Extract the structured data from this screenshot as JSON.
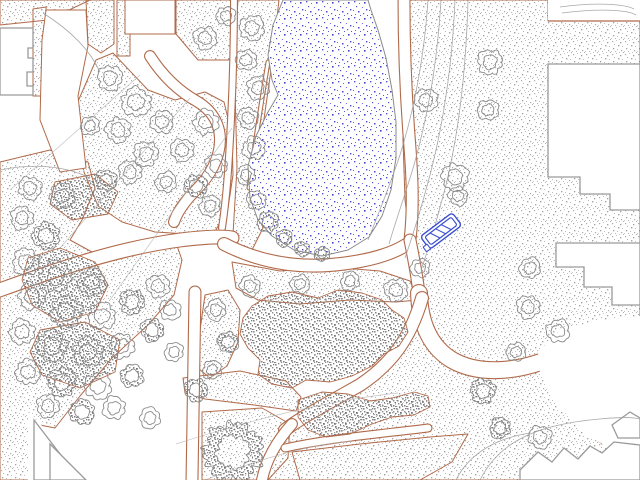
{
  "scene": {
    "colors": {
      "background": "#ffffff",
      "bed_outline": "#b06a4a",
      "building_outline": "#9a9a9a",
      "tree_line": "#8a8a8a",
      "contour": "#9f9f9f",
      "sight_line": "#b0b0b0",
      "water_dot": "#4a4ad0",
      "water_outline": "#8a8a8a",
      "bench": "#3c50d0"
    },
    "pond": {
      "pts": "283,0 273,25 268,55 272,80 278,95 268,112 256,136 248,166 250,198 258,220 272,236 294,250 322,256 348,250 369,237 382,216 391,190 396,158 396,122 392,90 386,58 378,30 371,10 368,0"
    },
    "plantings": [
      {
        "pts": "402,0 548,0 548,21 640,21 640,480 266,480 272,458 284,438 300,422 324,404 354,384 382,360 402,334 414,310 419,293 410,240 405,200 403,140 403,80"
      },
      {
        "pts": "0,0 90,0 48,20 0,25"
      },
      {
        "pts": "86,0 114,0 114,44 101,53 88,44"
      },
      {
        "pts": "33,9 46,7 46,96 33,96"
      },
      {
        "pts": "117,0 130,0 130,56 117,56"
      },
      {
        "pts": "176,0 237,0 237,60 198,60 176,34"
      },
      {
        "pts": "238,0 279,0 271,70 261,140 252,190 263,228 247,260 233,234 237,168 235,88 236,30"
      },
      {
        "pts": "76,106 96,60 113,53 148,90 175,100 205,92 224,102 232,135 233,175 228,208 216,230 188,234 155,232 122,222 98,206 84,172 74,136"
      },
      {
        "pts": "0,162 50,150 88,162 95,188 82,220 70,240 92,252 150,242 175,240 182,260 174,295 148,325 112,358 80,396 55,428 35,424 33,480 0,480"
      },
      {
        "pts": "232,262 280,271 330,267 380,271 410,281 418,300 396,302 350,300 300,304 258,300 236,288"
      },
      {
        "pts": "205,295 228,290 240,310 238,342 227,366 210,378 198,368 200,330"
      },
      {
        "pts": "183,378 240,371 286,381 301,397 296,411 254,405 205,399 185,393"
      },
      {
        "pts": "202,412 262,408 290,424 288,458 268,480 202,480"
      },
      {
        "pts": "292,452 360,444 430,437 468,434 452,462 420,480 300,480"
      },
      {
        "pts": "590,406 618,402 624,428 602,444 584,428"
      }
    ],
    "paths": [
      {
        "d": "M234,0 C234,40 233,80 231,120 C229,160 227,195 222,228",
        "w": 8
      },
      {
        "d": "M268,62 C260,110 254,150 249,188",
        "w": 5
      },
      {
        "d": "M150,56 C164,78 180,92 198,102 C214,112 220,126 220,140 C220,158 210,176 196,190 C186,200 178,210 174,222",
        "w": 12
      },
      {
        "d": "M-6,292 C60,268 120,248 180,240 C205,237 222,236 232,238",
        "w": 15
      },
      {
        "d": "M195,292 L192,480",
        "w": 13
      },
      {
        "d": "M224,244 C255,260 290,268 330,265 C365,262 390,255 406,245",
        "w": 14
      },
      {
        "d": "M404,0 C404,50 406,95 409,135 C412,172 414,205 410,240",
        "w": 13
      },
      {
        "d": "M410,240 C414,260 417,276 419,293",
        "w": 13
      },
      {
        "d": "M419,293 C420,326 432,348 452,360 C480,376 520,372 556,356 C590,342 615,336 640,334",
        "w": 18
      },
      {
        "d": "M422,298 C410,340 390,365 360,385 C330,402 300,418 285,430",
        "w": 14
      },
      {
        "d": "M292,424 C276,442 266,460 262,480",
        "w": 12
      },
      {
        "d": "M285,448 C330,438 380,434 428,428",
        "w": 9
      }
    ],
    "whites": [
      {
        "pts": "46,10 86,10 88,46 78,96 86,168 60,172 40,120 42,40",
        "stroke": true
      },
      {
        "pts": "125,0 175,0 175,34 125,34",
        "stroke": true
      },
      {
        "pts": "548,0 640,0 640,20 548,20",
        "stroke": false
      },
      {
        "pts": "538,352 560,330 600,320 640,316 640,450 612,450 580,430 554,400 540,374",
        "stroke": false
      },
      {
        "pts": "28,412 97,480 28,480",
        "stroke": false
      }
    ],
    "dense": [
      {
        "pts": "252,306 268,296 292,292 318,298 338,290 362,293 382,300 392,310 404,318 408,332 399,346 384,354 372,366 352,376 330,382 306,380 292,388 272,384 258,374 260,360 248,348 240,334 243,318"
      },
      {
        "pts": "298,400 322,392 348,394 370,401 392,398 414,392 428,396 430,407 414,415 392,417 372,424 350,434 326,437 308,430 298,417"
      },
      {
        "pts": "28,258 60,248 95,262 108,285 95,312 60,322 32,305 22,280"
      },
      {
        "pts": "40,330 85,322 120,340 115,372 80,388 42,375 30,352"
      },
      {
        "pts": "55,182 95,174 118,192 108,214 72,220 50,204"
      }
    ],
    "buildings": [
      {
        "pts": "0,28 33,28 33,48 28,48 28,58 33,58 33,72 27,72 27,86 33,86 33,95 0,95"
      },
      {
        "pts": "548,64 640,64 640,210 610,210 610,194 580,194 580,177 548,177"
      },
      {
        "pts": "556,243 640,243 640,305 612,305 612,287 584,287 584,267 556,267"
      },
      {
        "pts": "520,470 538,452 552,462 564,448 578,459 590,446 602,453 614,442 640,445 640,480 520,480"
      },
      {
        "pts": "612,425 630,412 640,418 640,438 618,438"
      },
      {
        "pts": "34,420 34,480 80,480"
      },
      {
        "pts": "50,444 50,480 86,480"
      }
    ],
    "lines": [
      {
        "d": "M548,21 L640,21",
        "color": "bed_outline"
      }
    ],
    "trees": [
      [
        252,
        28,
        13,
        0
      ],
      [
        246,
        60,
        11,
        0
      ],
      [
        258,
        88,
        12,
        0
      ],
      [
        248,
        118,
        11,
        0
      ],
      [
        254,
        148,
        12,
        0
      ],
      [
        246,
        175,
        10,
        0
      ],
      [
        256,
        200,
        10,
        0
      ],
      [
        268,
        222,
        11,
        1
      ],
      [
        284,
        238,
        9,
        1
      ],
      [
        302,
        249,
        8,
        1
      ],
      [
        322,
        254,
        8,
        1
      ],
      [
        205,
        38,
        12,
        0
      ],
      [
        226,
        16,
        10,
        0
      ],
      [
        110,
        78,
        13,
        0
      ],
      [
        136,
        102,
        15,
        0
      ],
      [
        90,
        126,
        10,
        0
      ],
      [
        118,
        130,
        13,
        0
      ],
      [
        162,
        122,
        12,
        0
      ],
      [
        146,
        154,
        13,
        0
      ],
      [
        182,
        150,
        12,
        0
      ],
      [
        206,
        122,
        13,
        0
      ],
      [
        216,
        166,
        12,
        0
      ],
      [
        196,
        186,
        12,
        1
      ],
      [
        166,
        182,
        11,
        0
      ],
      [
        130,
        172,
        12,
        0
      ],
      [
        106,
        180,
        11,
        1
      ],
      [
        210,
        206,
        11,
        0
      ],
      [
        30,
        188,
        12,
        0
      ],
      [
        62,
        196,
        13,
        0
      ],
      [
        22,
        218,
        12,
        0
      ],
      [
        46,
        236,
        14,
        1
      ],
      [
        26,
        262,
        14,
        0
      ],
      [
        56,
        276,
        16,
        1
      ],
      [
        92,
        282,
        14,
        1
      ],
      [
        32,
        296,
        14,
        0
      ],
      [
        66,
        312,
        16,
        1
      ],
      [
        102,
        316,
        14,
        0
      ],
      [
        132,
        302,
        13,
        1
      ],
      [
        158,
        286,
        12,
        0
      ],
      [
        22,
        332,
        13,
        0
      ],
      [
        52,
        346,
        16,
        1
      ],
      [
        88,
        352,
        15,
        1
      ],
      [
        122,
        346,
        13,
        0
      ],
      [
        152,
        330,
        12,
        1
      ],
      [
        28,
        372,
        13,
        0
      ],
      [
        62,
        382,
        15,
        1
      ],
      [
        98,
        386,
        14,
        0
      ],
      [
        132,
        376,
        12,
        1
      ],
      [
        48,
        406,
        12,
        0
      ],
      [
        82,
        412,
        13,
        1
      ],
      [
        114,
        408,
        12,
        0
      ],
      [
        150,
        418,
        11,
        0
      ],
      [
        170,
        310,
        11,
        0
      ],
      [
        174,
        352,
        10,
        0
      ],
      [
        250,
        286,
        11,
        0
      ],
      [
        300,
        284,
        10,
        0
      ],
      [
        350,
        281,
        10,
        0
      ],
      [
        396,
        290,
        12,
        0
      ],
      [
        420,
        268,
        10,
        0
      ],
      [
        216,
        310,
        11,
        0
      ],
      [
        228,
        342,
        11,
        1
      ],
      [
        212,
        370,
        10,
        0
      ],
      [
        196,
        390,
        12,
        1
      ],
      [
        233,
        452,
        30,
        1
      ],
      [
        490,
        62,
        13,
        0
      ],
      [
        426,
        100,
        12,
        0
      ],
      [
        488,
        110,
        11,
        0
      ],
      [
        455,
        177,
        14,
        0
      ],
      [
        458,
        196,
        10,
        0
      ],
      [
        530,
        268,
        11,
        0
      ],
      [
        528,
        307,
        12,
        0
      ],
      [
        558,
        331,
        12,
        0
      ],
      [
        483,
        391,
        13,
        1
      ],
      [
        540,
        437,
        12,
        0
      ],
      [
        516,
        352,
        10,
        0
      ],
      [
        500,
        428,
        11,
        1
      ]
    ],
    "contours": [
      {
        "d": "M43,13 C70,30 90,50 100,72",
        "k": "c"
      },
      {
        "d": "M428,0 C424,60 414,110 400,155 C390,185 378,215 368,240",
        "k": "c"
      },
      {
        "d": "M441,0 C437,65 428,115 414,165 C406,192 396,220 389,244",
        "k": "c"
      },
      {
        "d": "M455,0 C452,70 443,125 430,175 C422,205 414,232 405,258",
        "k": "c"
      },
      {
        "d": "M468,0 C466,75 458,135 446,185 C438,215 430,245 421,270",
        "k": "c"
      },
      {
        "d": "M0,170 C40,162 70,168 90,178",
        "k": "c"
      },
      {
        "d": "M140,75 L10,190",
        "k": "s"
      },
      {
        "d": "M190,98 L60,248",
        "k": "s"
      },
      {
        "d": "M232,128 L110,300",
        "k": "s"
      },
      {
        "d": "M480,480 C500,440 540,424 600,419 C620,417 632,417 640,419",
        "k": "c"
      },
      {
        "d": "M456,480 C470,452 498,438 530,433",
        "k": "c"
      },
      {
        "d": "M176,444 C250,420 330,400 398,393",
        "k": "s"
      },
      {
        "d": "M205,480 C262,458 312,444 352,441",
        "k": "s"
      },
      {
        "d": "M560,7 C595,2 625,4 634,9",
        "k": "c"
      },
      {
        "d": "M562,13 C600,8 628,10 636,15",
        "k": "c"
      }
    ],
    "bench": {
      "x": 441,
      "y": 231,
      "w": 40,
      "h": 16,
      "rot": -37
    }
  }
}
